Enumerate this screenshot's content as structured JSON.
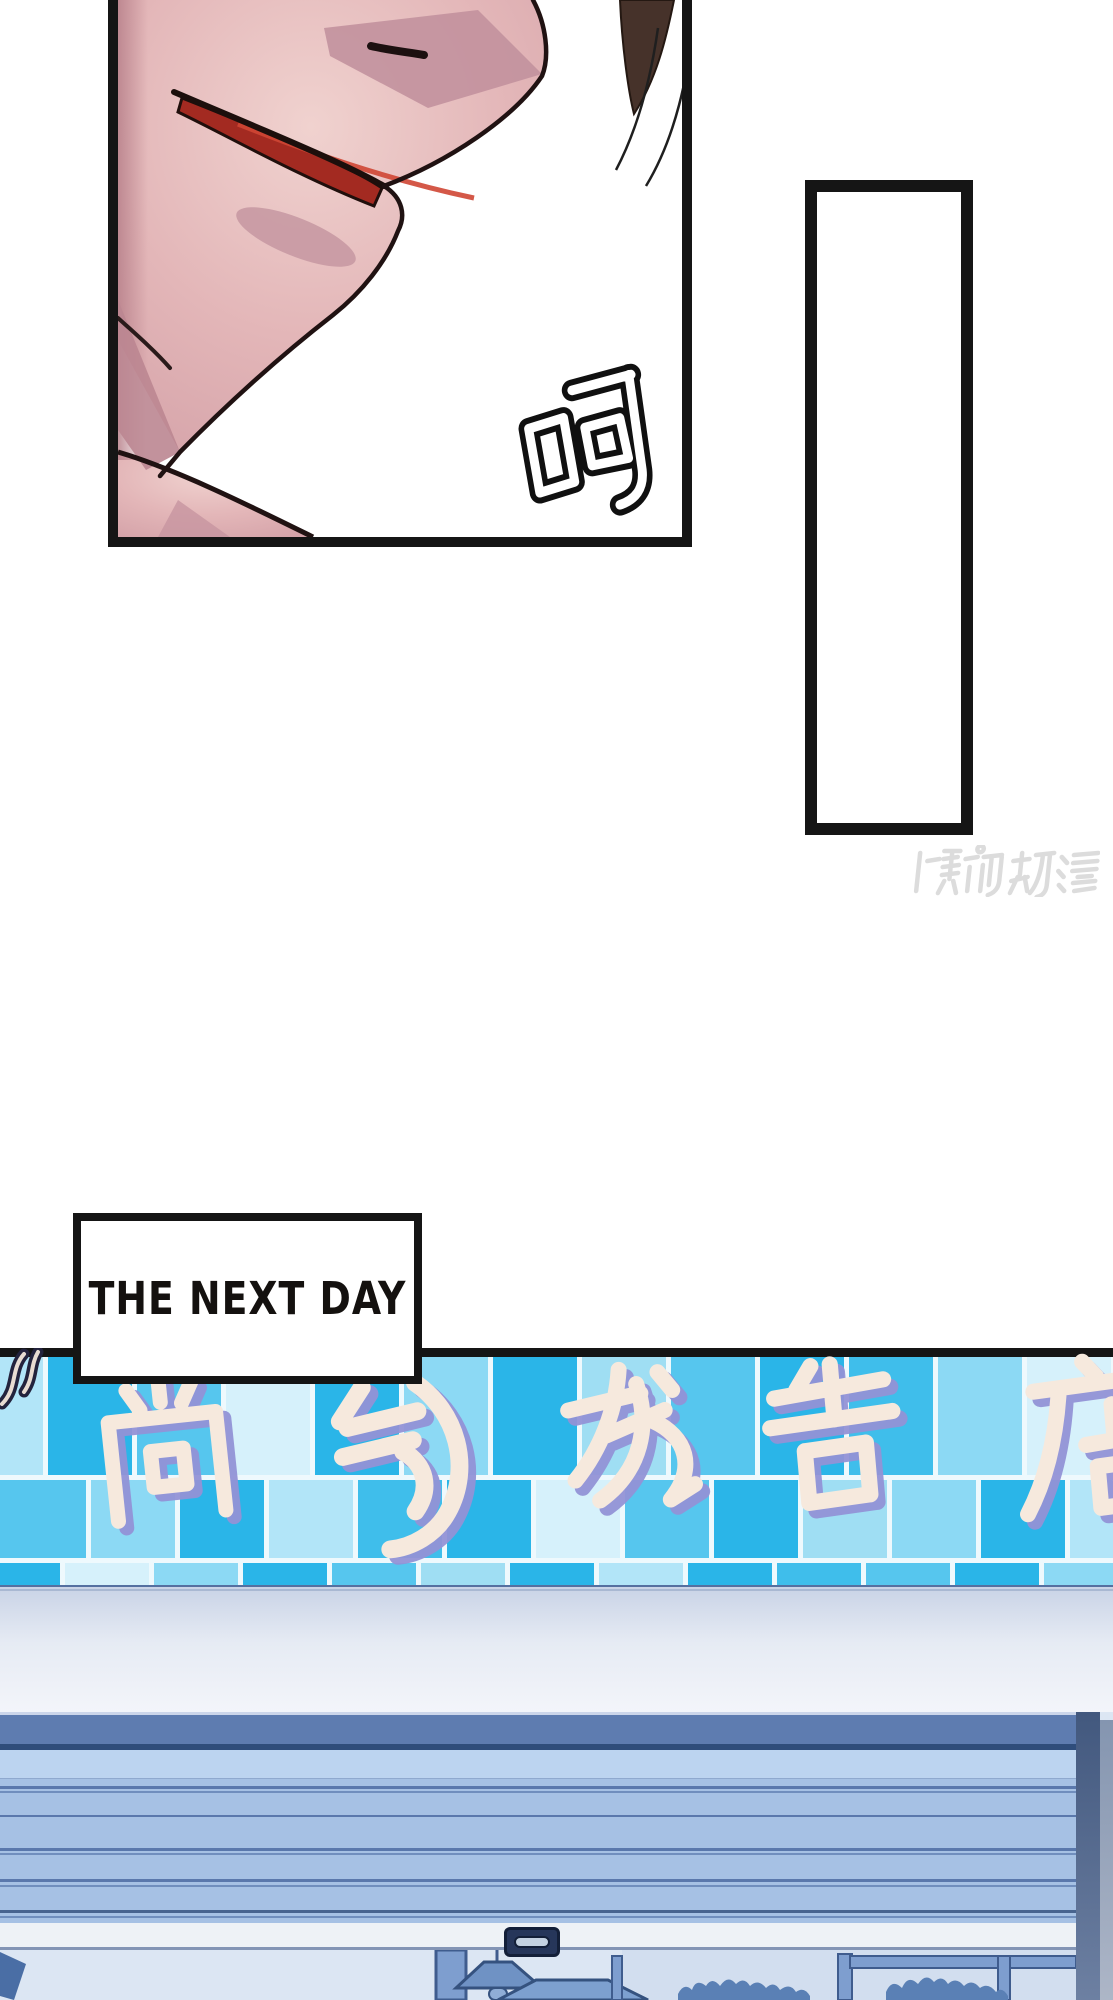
{
  "page": {
    "width": 1113,
    "height": 2000,
    "background": "#ffffff"
  },
  "face_panel": {
    "sfx_text": "呵"
  },
  "speech_bubble_rect": {
    "text": ""
  },
  "watermark": {
    "text": "腾讯动漫",
    "color": "#dcdcdc"
  },
  "caption_box": {
    "text": "THE NEXT DAY"
  },
  "storefront_sign": {
    "text": "尚气龙告店",
    "fill": "#f6e9dd",
    "shadow": "#9292d6"
  },
  "colors": {
    "panel_border": "#151515",
    "skin_light": "#f0d2cf",
    "skin_dark": "#d5a3a9",
    "lip_red": "#a32a21",
    "tile_grout": "#eef9fd",
    "shutter": "#a6c1e4",
    "housing": "#5e7cb0",
    "bar": "#eef2f6",
    "interior_bg": "#dce6f3",
    "silhouette": "#6286bb",
    "tile_palette": [
      "#2ab5e8",
      "#56c6ee",
      "#8cd9f4",
      "#b2e5f8",
      "#d6f1fb",
      "#9fdef3",
      "#3fbeeb"
    ]
  }
}
